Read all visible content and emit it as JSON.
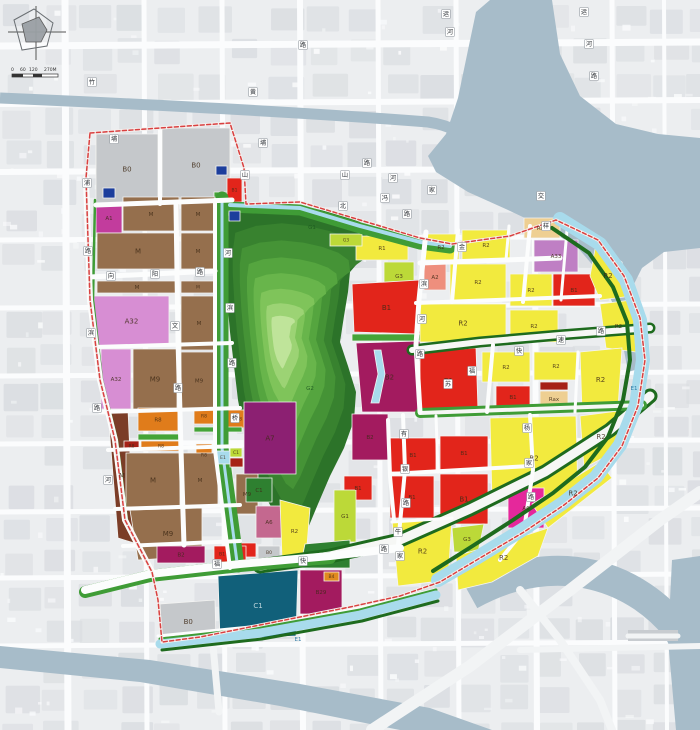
{
  "map_title": "land-use-planning-map",
  "scale_bar": {
    "t0": "0",
    "t1": "60",
    "t2": "120",
    "t3": "270M"
  },
  "palette": {
    "B0": "#c5c8cb",
    "M": "#956f4d",
    "Md": "#7b3d27",
    "A1": "#c23c9d",
    "A32": "#d78ed3",
    "A33": "#bf7fc4",
    "A2": "#ee8f7d",
    "A6": "#c4688f",
    "A6b": "#e5289b",
    "A7": "#8c2072",
    "R2": "#f2ea3e",
    "Rax": "#eecf92",
    "R8": "#e07c1b",
    "B1": "#e2251b",
    "B1d": "#a62117",
    "B2": "#a31b5f",
    "B29": "#a31b5f",
    "B4": "#e08a1f",
    "C1": "#11607a",
    "G1": "#45a438",
    "G2": "#2e8030",
    "G3": "#bcd938",
    "E1": "#a8dbec",
    "U": "#1c3e9c"
  },
  "park": {
    "center": [
      280,
      336
    ],
    "ring_colors": [
      "#2c7329",
      "#38822f",
      "#459336",
      "#55a53f",
      "#68b54b",
      "#7fc45a",
      "#9cd374",
      "#bfe49a"
    ],
    "ring_factors": [
      1,
      0.86,
      0.73,
      0.6,
      0.48,
      0.36,
      0.25,
      0.155
    ],
    "outline": [
      [
        228,
        216
      ],
      [
        252,
        208
      ],
      [
        282,
        205
      ],
      [
        312,
        208
      ],
      [
        338,
        214
      ],
      [
        360,
        222
      ],
      [
        374,
        232
      ],
      [
        376,
        248
      ],
      [
        362,
        258
      ],
      [
        350,
        272
      ],
      [
        348,
        292
      ],
      [
        344,
        316
      ],
      [
        340,
        342
      ],
      [
        348,
        366
      ],
      [
        356,
        392
      ],
      [
        354,
        420
      ],
      [
        344,
        448
      ],
      [
        330,
        476
      ],
      [
        318,
        504
      ],
      [
        308,
        528
      ],
      [
        298,
        546
      ],
      [
        288,
        538
      ],
      [
        276,
        516
      ],
      [
        262,
        490
      ],
      [
        252,
        462
      ],
      [
        244,
        432
      ],
      [
        238,
        400
      ],
      [
        234,
        366
      ],
      [
        230,
        332
      ],
      [
        227,
        298
      ],
      [
        225,
        262
      ],
      [
        225,
        238
      ]
    ]
  },
  "zones": [
    {
      "l": "B0",
      "t": "B0",
      "r": [
        96,
        134,
        62,
        70
      ]
    },
    {
      "l": "B0",
      "t": "B0",
      "r": [
        162,
        128,
        68,
        74
      ]
    },
    {
      "l": "",
      "t": "U",
      "r": [
        103,
        188,
        12,
        10
      ]
    },
    {
      "l": "",
      "t": "U",
      "r": [
        216,
        166,
        11,
        9
      ]
    },
    {
      "l": "",
      "t": "G1",
      "r": [
        214,
        192,
        13,
        13
      ]
    },
    {
      "l": "B1",
      "t": "B1",
      "r": [
        227,
        178,
        15,
        24
      ]
    },
    {
      "l": "A1",
      "t": "A1",
      "r": [
        96,
        203,
        26,
        30
      ]
    },
    {
      "l": "M",
      "t": "M",
      "r": [
        123,
        197,
        56,
        34
      ]
    },
    {
      "l": "M",
      "t": "M",
      "r": [
        181,
        197,
        34,
        34
      ]
    },
    {
      "l": "M",
      "t": "M",
      "r": [
        97,
        233,
        82,
        36
      ]
    },
    {
      "l": "M",
      "t": "M",
      "r": [
        181,
        233,
        34,
        36
      ]
    },
    {
      "l": "M",
      "t": "M",
      "r": [
        97,
        281,
        80,
        12
      ]
    },
    {
      "l": "M",
      "t": "M",
      "r": [
        181,
        281,
        34,
        12
      ]
    },
    {
      "l": "A32",
      "t": "A32",
      "r": [
        94,
        296,
        75,
        50
      ]
    },
    {
      "l": "A32",
      "t": "A32",
      "r": [
        101,
        349,
        30,
        60
      ]
    },
    {
      "l": "M9",
      "t": "M",
      "r": [
        133,
        349,
        44,
        60
      ]
    },
    {
      "l": "M",
      "t": "M",
      "r": [
        181,
        296,
        36,
        54
      ]
    },
    {
      "l": "M9",
      "t": "M",
      "r": [
        181,
        352,
        36,
        57
      ]
    },
    {
      "l": "M",
      "t": "Md",
      "p": "108,412 128,410 134,543 118,538"
    },
    {
      "l": "R8",
      "t": "R8",
      "r": [
        138,
        408,
        40,
        23
      ]
    },
    {
      "l": "R8",
      "t": "R8",
      "r": [
        194,
        408,
        20,
        16
      ]
    },
    {
      "l": "R8",
      "t": "R8",
      "r": [
        228,
        410,
        22,
        18
      ]
    },
    {
      "l": "",
      "t": "G1",
      "r": [
        138,
        434,
        44,
        6
      ]
    },
    {
      "l": "",
      "t": "G1",
      "r": [
        194,
        427,
        48,
        5
      ]
    },
    {
      "l": "R8",
      "t": "B1d",
      "r": [
        124,
        441,
        15,
        10
      ]
    },
    {
      "l": "R8",
      "t": "R8",
      "r": [
        141,
        441,
        40,
        10
      ]
    },
    {
      "l": "R8",
      "t": "R8",
      "r": [
        196,
        444,
        16,
        22
      ]
    },
    {
      "l": "M",
      "t": "M",
      "r": [
        126,
        453,
        54,
        54
      ]
    },
    {
      "l": "M",
      "t": "M",
      "r": [
        182,
        453,
        36,
        54
      ]
    },
    {
      "l": "M9",
      "t": "M",
      "p": "130,510 202,508 202,556 138,560"
    },
    {
      "l": "M9",
      "t": "M",
      "r": [
        236,
        474,
        22,
        40
      ]
    },
    {
      "l": "A7",
      "t": "A7",
      "r": [
        244,
        402,
        52,
        72
      ]
    },
    {
      "l": "C1",
      "t": "G2",
      "r": [
        246,
        478,
        26,
        24
      ]
    },
    {
      "l": "A6",
      "t": "A6",
      "r": [
        256,
        506,
        26,
        32
      ]
    },
    {
      "l": "R2",
      "t": "R2",
      "p": "280,500 310,508 306,558 282,558"
    },
    {
      "l": "B0",
      "t": "B0",
      "r": [
        258,
        546,
        22,
        13
      ]
    },
    {
      "l": "",
      "t": "B1",
      "r": [
        240,
        543,
        16,
        14
      ]
    },
    {
      "l": "B2",
      "t": "B2",
      "r": [
        157,
        546,
        48,
        17
      ]
    },
    {
      "l": "B1",
      "t": "B1",
      "r": [
        214,
        546,
        16,
        16
      ]
    },
    {
      "l": "",
      "t": "B1",
      "r": [
        232,
        546,
        14,
        16
      ]
    },
    {
      "l": "",
      "t": "G1",
      "r": [
        214,
        563,
        32,
        5
      ]
    },
    {
      "l": "B0",
      "t": "B0",
      "p": "160,604 215,600 216,642 162,640"
    },
    {
      "l": "C1",
      "t": "C1",
      "p": "218,576 298,570 296,636 220,640"
    },
    {
      "l": "B29",
      "t": "B29",
      "r": [
        300,
        570,
        42,
        44
      ]
    },
    {
      "l": "B4",
      "t": "B4",
      "r": [
        324,
        572,
        15,
        9
      ]
    },
    {
      "l": "R1",
      "t": "R2",
      "r": [
        356,
        236,
        52,
        24
      ]
    },
    {
      "l": "G3",
      "t": "G3",
      "r": [
        384,
        262,
        30,
        28
      ]
    },
    {
      "l": "B1",
      "t": "B1",
      "p": "352,284 420,280 420,334 354,332"
    },
    {
      "l": "",
      "t": "G1",
      "r": [
        352,
        334,
        68,
        7
      ]
    },
    {
      "l": "B2",
      "t": "B2",
      "p": "356,343 420,341 420,412 362,412"
    },
    {
      "l": "",
      "t": "E1",
      "p": "374,350 381,350 385,374 379,403 371,403 378,374"
    },
    {
      "l": "B2",
      "t": "B2",
      "r": [
        352,
        414,
        36,
        46
      ]
    },
    {
      "l": "B1",
      "t": "B1",
      "r": [
        344,
        476,
        28,
        24
      ]
    },
    {
      "l": "G1",
      "t": "G3",
      "r": [
        334,
        490,
        22,
        52
      ]
    },
    {
      "l": "",
      "t": "G2",
      "p": "305,544 350,540 350,568 300,568"
    },
    {
      "l": "G3",
      "t": "G3",
      "r": [
        330,
        234,
        32,
        12
      ]
    },
    {
      "l": "R2",
      "t": "R2",
      "r": [
        423,
        234,
        36,
        26
      ]
    },
    {
      "l": "R2",
      "t": "R2",
      "r": [
        462,
        230,
        48,
        30
      ]
    },
    {
      "l": "Rax",
      "t": "Rax",
      "r": [
        524,
        218,
        36,
        20
      ]
    },
    {
      "l": "A33",
      "t": "A33",
      "r": [
        534,
        240,
        44,
        32
      ]
    },
    {
      "l": "B1",
      "t": "B1",
      "r": [
        553,
        274,
        42,
        32
      ]
    },
    {
      "l": "R2",
      "t": "R2",
      "p": "596,244 622,262 632,296 600,300 590,276"
    },
    {
      "l": "A2",
      "t": "A2",
      "r": [
        424,
        264,
        22,
        26
      ]
    },
    {
      "l": "R2",
      "t": "R2",
      "r": [
        450,
        264,
        56,
        36
      ]
    },
    {
      "l": "R2",
      "t": "R2",
      "r": [
        510,
        274,
        42,
        32
      ]
    },
    {
      "l": "R2",
      "t": "R2",
      "r": [
        420,
        304,
        86,
        38
      ]
    },
    {
      "l": "R2",
      "t": "R2",
      "r": [
        510,
        310,
        48,
        32
      ]
    },
    {
      "l": "R2",
      "t": "R2",
      "p": "600,304 632,300 636,352 606,348"
    },
    {
      "l": "B1",
      "t": "B1",
      "p": "420,352 476,348 478,410 420,412"
    },
    {
      "l": "R2",
      "t": "R2",
      "r": [
        482,
        352,
        48,
        30
      ]
    },
    {
      "l": "B1",
      "t": "B1",
      "r": [
        496,
        386,
        34,
        22
      ]
    },
    {
      "l": "",
      "t": "B1d",
      "r": [
        540,
        382,
        28,
        8
      ]
    },
    {
      "l": "Rax",
      "t": "Rax",
      "r": [
        540,
        391,
        28,
        16
      ]
    },
    {
      "l": "R2",
      "t": "R2",
      "r": [
        534,
        352,
        44,
        28
      ]
    },
    {
      "l": "R2",
      "t": "R2",
      "p": "580,352 622,348 618,408 582,410"
    },
    {
      "l": "B1",
      "t": "B1",
      "r": [
        390,
        438,
        46,
        34
      ]
    },
    {
      "l": "B1",
      "t": "B1",
      "r": [
        390,
        476,
        44,
        42
      ]
    },
    {
      "l": "B1",
      "t": "B1",
      "r": [
        440,
        436,
        48,
        34
      ]
    },
    {
      "l": "B1",
      "t": "B1",
      "r": [
        440,
        474,
        48,
        50
      ]
    },
    {
      "l": "R2",
      "t": "R2",
      "p": "490,418 576,416 578,498 492,500"
    },
    {
      "l": "R2",
      "t": "R2",
      "p": "580,416 626,410 614,452 584,468"
    },
    {
      "l": "A6",
      "t": "A6b",
      "r": [
        508,
        488,
        36,
        40
      ]
    },
    {
      "l": "R2",
      "t": "R2",
      "p": "532,504 600,462 612,478 548,528"
    },
    {
      "l": "R2",
      "t": "R2",
      "p": "392,520 452,518 448,580 398,586"
    },
    {
      "l": "G3",
      "t": "G3",
      "p": "452,528 484,524 478,552 454,552"
    },
    {
      "l": "R2",
      "t": "R2",
      "p": "456,556 530,534 548,528 538,556 492,582 458,590"
    }
  ],
  "over_zones": [
    {
      "l": "E1",
      "t": "E1",
      "r": [
        216,
        451,
        14,
        13
      ]
    },
    {
      "l": "C1",
      "t": "G3",
      "r": [
        230,
        448,
        12,
        9
      ]
    },
    {
      "l": "",
      "t": "B1d",
      "r": [
        230,
        458,
        13,
        9
      ]
    },
    {
      "l": "",
      "t": "U",
      "r": [
        229,
        211,
        11,
        10
      ]
    }
  ],
  "area_labels": [
    {
      "l": "E1",
      "x": 634,
      "y": 390
    },
    {
      "l": "E1",
      "x": 298,
      "y": 641
    },
    {
      "l": "G1",
      "x": 312,
      "y": 229
    },
    {
      "l": "G2",
      "x": 310,
      "y": 390
    }
  ],
  "road_labels": [
    {
      "ch": "竹",
      "x": 92,
      "y": 82
    },
    {
      "ch": "埔",
      "x": 114,
      "y": 139
    },
    {
      "ch": "黄",
      "x": 253,
      "y": 92
    },
    {
      "ch": "路",
      "x": 303,
      "y": 45
    },
    {
      "ch": "运",
      "x": 446,
      "y": 14
    },
    {
      "ch": "河",
      "x": 450,
      "y": 32
    },
    {
      "ch": "运",
      "x": 584,
      "y": 12
    },
    {
      "ch": "河",
      "x": 589,
      "y": 44
    },
    {
      "ch": "路",
      "x": 594,
      "y": 76
    },
    {
      "ch": "埔",
      "x": 263,
      "y": 143
    },
    {
      "ch": "山",
      "x": 245,
      "y": 175
    },
    {
      "ch": "山",
      "x": 345,
      "y": 175
    },
    {
      "ch": "北",
      "x": 343,
      "y": 206
    },
    {
      "ch": "路",
      "x": 367,
      "y": 163
    },
    {
      "ch": "河",
      "x": 393,
      "y": 178
    },
    {
      "ch": "冯",
      "x": 385,
      "y": 198
    },
    {
      "ch": "家",
      "x": 432,
      "y": 190
    },
    {
      "ch": "路",
      "x": 407,
      "y": 214
    },
    {
      "ch": "浦",
      "x": 87,
      "y": 183
    },
    {
      "ch": "路",
      "x": 88,
      "y": 251
    },
    {
      "ch": "滨",
      "x": 91,
      "y": 333
    },
    {
      "ch": "路",
      "x": 97,
      "y": 408
    },
    {
      "ch": "河",
      "x": 108,
      "y": 480
    },
    {
      "ch": "向",
      "x": 111,
      "y": 276
    },
    {
      "ch": "阳",
      "x": 155,
      "y": 274
    },
    {
      "ch": "路",
      "x": 200,
      "y": 272
    },
    {
      "ch": "文",
      "x": 175,
      "y": 326
    },
    {
      "ch": "路",
      "x": 178,
      "y": 388
    },
    {
      "ch": "河",
      "x": 228,
      "y": 253
    },
    {
      "ch": "滨",
      "x": 230,
      "y": 308
    },
    {
      "ch": "路",
      "x": 232,
      "y": 363
    },
    {
      "ch": "桥",
      "x": 235,
      "y": 418
    },
    {
      "ch": "金",
      "x": 462,
      "y": 247
    },
    {
      "ch": "交",
      "x": 541,
      "y": 196
    },
    {
      "ch": "样",
      "x": 546,
      "y": 226
    },
    {
      "ch": "滨",
      "x": 424,
      "y": 284
    },
    {
      "ch": "河",
      "x": 422,
      "y": 319
    },
    {
      "ch": "路",
      "x": 420,
      "y": 354
    },
    {
      "ch": "苏",
      "x": 448,
      "y": 384
    },
    {
      "ch": "福",
      "x": 472,
      "y": 371
    },
    {
      "ch": "快",
      "x": 519,
      "y": 351
    },
    {
      "ch": "速",
      "x": 561,
      "y": 340
    },
    {
      "ch": "路",
      "x": 601,
      "y": 331
    },
    {
      "ch": "福",
      "x": 217,
      "y": 564
    },
    {
      "ch": "快",
      "x": 303,
      "y": 561
    },
    {
      "ch": "路",
      "x": 384,
      "y": 549
    },
    {
      "ch": "有",
      "x": 404,
      "y": 434
    },
    {
      "ch": "银",
      "x": 405,
      "y": 469
    },
    {
      "ch": "路",
      "x": 406,
      "y": 503
    },
    {
      "ch": "杨",
      "x": 527,
      "y": 428
    },
    {
      "ch": "家",
      "x": 529,
      "y": 463
    },
    {
      "ch": "路",
      "x": 531,
      "y": 497
    },
    {
      "ch": "牛",
      "x": 398,
      "y": 532
    },
    {
      "ch": "家",
      "x": 400,
      "y": 556
    }
  ]
}
